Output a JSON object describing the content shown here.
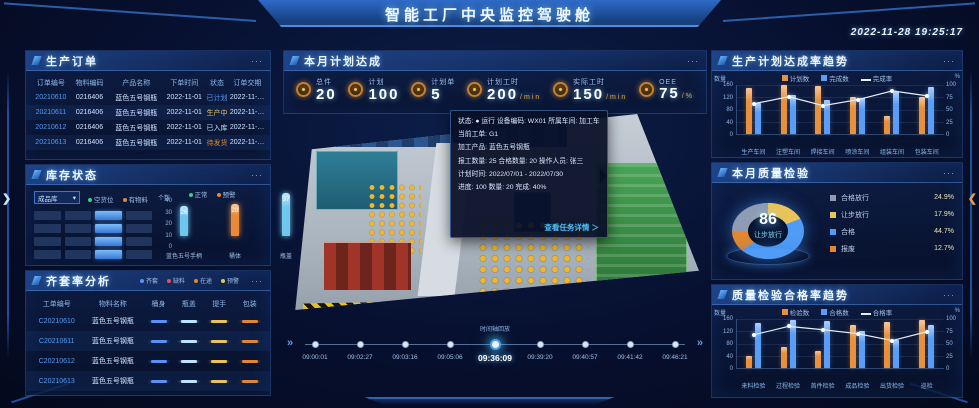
{
  "ui": {
    "more": "···",
    "caret": "▾",
    "chev_left": "❯",
    "chev_right": "❮",
    "play": "»"
  },
  "header": {
    "title": "智能工厂中央监控驾驶舱",
    "timestamp": "2022-11-28 19:25:17"
  },
  "orders": {
    "title": "生产订单",
    "headers": [
      "订单编号",
      "物料编码",
      "产品名称",
      "下单时间",
      "状态",
      "订单交期"
    ],
    "rows": [
      {
        "cells": [
          "20210610",
          "0216406",
          "蓝色五号钢瓶",
          "2022-11-01",
          "已计划",
          "2022-11-02"
        ],
        "status_color": "#4f9bf5"
      },
      {
        "cells": [
          "20210611",
          "0216406",
          "蓝色五号钢瓶",
          "2022-11-01",
          "生产中",
          "2022-11-02"
        ],
        "status_color": "#e8c35a"
      },
      {
        "cells": [
          "20210612",
          "0216406",
          "蓝色五号钢瓶",
          "2022-11-01",
          "已入库",
          "2022-11-02"
        ],
        "status_color": "#bfe3ff"
      },
      {
        "cells": [
          "20210613",
          "0216406",
          "蓝色五号钢瓶",
          "2022-11-01",
          "待发货",
          "2022-11-02"
        ],
        "status_color": "#e2862f"
      }
    ]
  },
  "inventory": {
    "title": "库存状态",
    "selector": "成品库",
    "grid_legend": [
      {
        "label": "空货位",
        "color": "#35d08a"
      },
      {
        "label": "有物料",
        "color": "#e2862f"
      }
    ],
    "grid": {
      "rows": 4,
      "cols": 4,
      "active_col": 2
    },
    "chart_data": {
      "type": "bar",
      "ylabel": "个数",
      "yticks": [
        40,
        30,
        20,
        10,
        0
      ],
      "ylim": [
        0,
        40
      ],
      "legend": [
        {
          "label": "正常",
          "color": "#35d08a"
        },
        {
          "label": "预警",
          "color": "#e2862f"
        }
      ],
      "categories": [
        "蓝色五号手柄",
        "桶体",
        "瓶盖"
      ],
      "values": [
        26,
        28,
        37
      ],
      "colors": [
        "#6fc6ee",
        "#e88a3a",
        "#6fc6ee"
      ]
    }
  },
  "kit": {
    "title": "齐套率分析",
    "legend": [
      {
        "label": "齐套",
        "color": "#5b8ff9"
      },
      {
        "label": "缺料",
        "color": "#e05555"
      },
      {
        "label": "在途",
        "color": "#e2862f"
      },
      {
        "label": "预警",
        "color": "#e8c35a"
      }
    ],
    "headers": [
      "工单编号",
      "物料名称",
      "桶身",
      "瓶盖",
      "提手",
      "包装"
    ],
    "rows": [
      {
        "id": "C20210610",
        "name": "蓝色五号钢瓶",
        "marks": [
          "#5b8ff9",
          "#bfe3ff",
          "#e8c35a",
          "#e2862f"
        ]
      },
      {
        "id": "C20210611",
        "name": "蓝色五号钢瓶",
        "marks": [
          "#5b8ff9",
          "#bfe3ff",
          "#e8c35a",
          "#e2862f"
        ]
      },
      {
        "id": "C20210612",
        "name": "蓝色五号钢瓶",
        "marks": [
          "#5b8ff9",
          "#bfe3ff",
          "#e8c35a",
          "#e2862f"
        ]
      },
      {
        "id": "C20210613",
        "name": "蓝色五号钢瓶",
        "marks": [
          "#5b8ff9",
          "#bfe3ff",
          "#e8c35a",
          "#e2862f"
        ]
      }
    ]
  },
  "plan": {
    "title": "本月计划达成",
    "kpis": [
      {
        "label": "总件",
        "value": "20",
        "unit": ""
      },
      {
        "label": "计划",
        "value": "100",
        "unit": ""
      },
      {
        "label": "计划单",
        "value": "5",
        "unit": ""
      },
      {
        "label": "计划工时",
        "value": "200",
        "unit": "min"
      },
      {
        "label": "实际工时",
        "value": "150",
        "unit": "min"
      },
      {
        "label": "OEE",
        "value": "75",
        "unit": "%"
      }
    ]
  },
  "map": {
    "tooltip": {
      "lines": [
        "状态: ● 运行   设备编码: WX01   所属车间: 加工车间",
        "当前工单: G1",
        "加工产品: 蓝色五号钢瓶",
        "报工数量: 25   合格数量: 20   操作人员: 张三",
        "计划时间: 2022/07/01 - 2022/07/30",
        "进度: 100   数量: 20   完成: 40%"
      ],
      "link": "查看任务详情 ＞"
    },
    "timeline": {
      "note": "时间轴回放",
      "times": [
        "09:00:01",
        "09:02:27",
        "09:03:16",
        "09:05:06",
        "09:36:09",
        "09:39:20",
        "09:40:57",
        "09:41:42",
        "09:46:21"
      ],
      "active_index": 4
    }
  },
  "trend1": {
    "title": "生产计划达成率趋势",
    "chart_data": {
      "type": "combo",
      "ylabel_left": "数量",
      "ylabel_right": "%",
      "yticks_left": [
        160,
        120,
        80,
        40,
        0
      ],
      "yticks_right": [
        100,
        75,
        50,
        25,
        0
      ],
      "ylim": [
        0,
        160
      ],
      "ylim_right": [
        0,
        100
      ],
      "legend": [
        {
          "label": "计划数",
          "color": "#e8913c",
          "type": "bar"
        },
        {
          "label": "完成数",
          "color": "#5b9df5",
          "type": "bar"
        },
        {
          "label": "完成率",
          "color": "#e6eef8",
          "type": "line"
        }
      ],
      "categories": [
        "生产车间",
        "注塑车间",
        "焊接车间",
        "喷涂车间",
        "组装车间",
        "包装车间"
      ],
      "series": [
        {
          "name": "计划数",
          "values": [
            150,
            160,
            158,
            120,
            60,
            122
          ]
        },
        {
          "name": "完成数",
          "values": [
            100,
            126,
            110,
            118,
            136,
            152
          ]
        },
        {
          "name": "完成率",
          "values": [
            62,
            76,
            58,
            70,
            88,
            78
          ],
          "axis": "right"
        }
      ]
    }
  },
  "quality": {
    "title": "本月质量检验",
    "center_value": "86",
    "center_label": "让步放行",
    "slices": [
      {
        "label": "合格放行",
        "value": "24.9%",
        "pct": 24.9,
        "color": "#8f9bb3"
      },
      {
        "label": "让步放行",
        "value": "17.9%",
        "pct": 17.9,
        "color": "#e8c35a"
      },
      {
        "label": "合格",
        "value": "44.7%",
        "pct": 44.7,
        "color": "#4f9bf5"
      },
      {
        "label": "报废",
        "value": "12.7%",
        "pct": 12.7,
        "color": "#e2862f"
      }
    ]
  },
  "trend2": {
    "title": "质量检验合格率趋势",
    "chart_data": {
      "type": "combo",
      "ylabel_left": "数量",
      "ylabel_right": "%",
      "yticks_left": [
        160,
        120,
        80,
        40,
        0
      ],
      "yticks_right": [
        100,
        75,
        50,
        25,
        0
      ],
      "ylim": [
        0,
        160
      ],
      "ylim_right": [
        0,
        100
      ],
      "legend": [
        {
          "label": "检验数",
          "color": "#e8913c",
          "type": "bar"
        },
        {
          "label": "合格数",
          "color": "#5b9df5",
          "type": "bar"
        },
        {
          "label": "合格率",
          "color": "#e6eef8",
          "type": "line"
        }
      ],
      "categories": [
        "来料检验",
        "过程检验",
        "首件检验",
        "成品检验",
        "出货检验",
        "巡检"
      ],
      "series": [
        {
          "name": "检验数",
          "values": [
            40,
            70,
            55,
            140,
            150,
            158
          ]
        },
        {
          "name": "合格数",
          "values": [
            148,
            158,
            155,
            120,
            92,
            140
          ]
        },
        {
          "name": "合格率",
          "values": [
            68,
            85,
            78,
            70,
            56,
            74
          ],
          "axis": "right"
        }
      ]
    }
  }
}
